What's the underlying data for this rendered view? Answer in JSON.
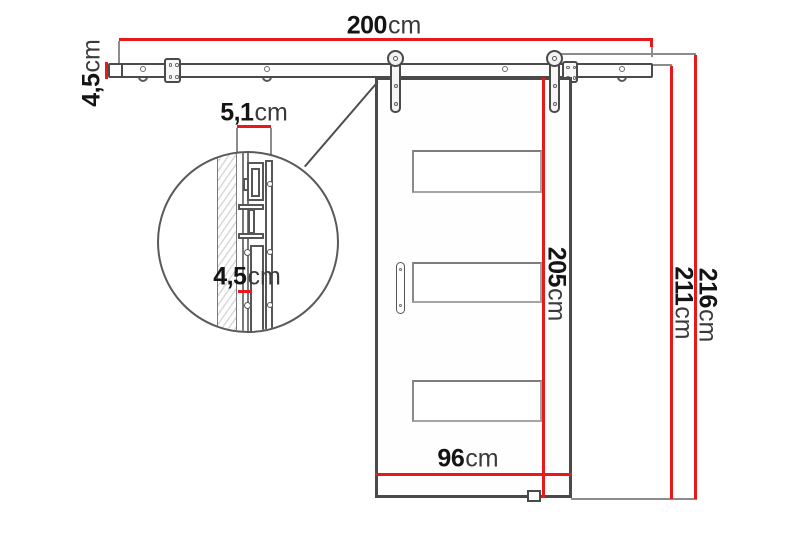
{
  "meta": {
    "type": "technical-dimension-drawing",
    "subject": "sliding barn door with wall-mounted rail system and hardware detail"
  },
  "colors": {
    "dimension_red": "#e8191c",
    "outline_dark": "#4a4a4a",
    "outline_mid": "#8c8c8c"
  },
  "dims": {
    "rail_width": {
      "value": "200",
      "unit": "cm"
    },
    "rail_height": {
      "value": "4,5",
      "unit": "cm"
    },
    "detail_width": {
      "value": "5,1",
      "unit": "cm"
    },
    "detail_height": {
      "value": "4,5",
      "unit": "cm"
    },
    "door_height": {
      "value": "205",
      "unit": "cm"
    },
    "door_width": {
      "value": "96",
      "unit": "cm"
    },
    "height_to_rail": {
      "value": "211",
      "unit": "cm"
    },
    "overall_height": {
      "value": "216",
      "unit": "cm"
    }
  }
}
